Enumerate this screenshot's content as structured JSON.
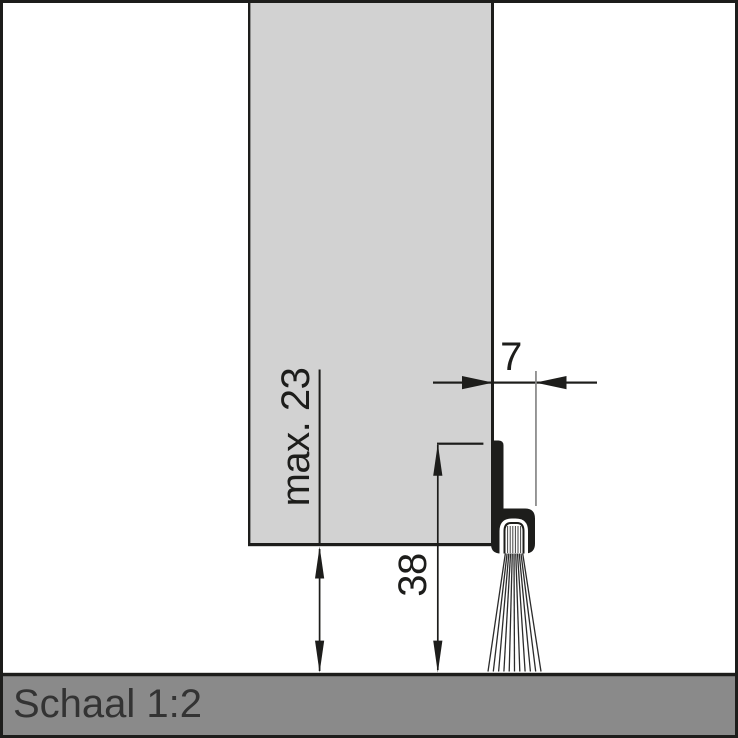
{
  "drawing": {
    "type": "technical-cross-section",
    "subject": "door bottom brush seal profile mounted on door above floor",
    "scale": {
      "label": "Schaal 1:2"
    },
    "dimensions": {
      "profile_width": {
        "label": "7",
        "orientation": "horizontal"
      },
      "door_floor_gap": {
        "label": "max. 23",
        "orientation": "vertical-rotated"
      },
      "profile_height": {
        "label": "38",
        "orientation": "vertical-rotated"
      }
    },
    "colors": {
      "background": "#ffffff",
      "door_fill": "#d2d2d2",
      "floor_fill": "#8a8a8a",
      "line": "#1d1d1b",
      "extension_line": "#878787",
      "scale_text": "#333333"
    },
    "parts": [
      {
        "name": "door-panel"
      },
      {
        "name": "brush-seal-profile"
      },
      {
        "name": "brush-bristles"
      },
      {
        "name": "floor"
      }
    ]
  }
}
